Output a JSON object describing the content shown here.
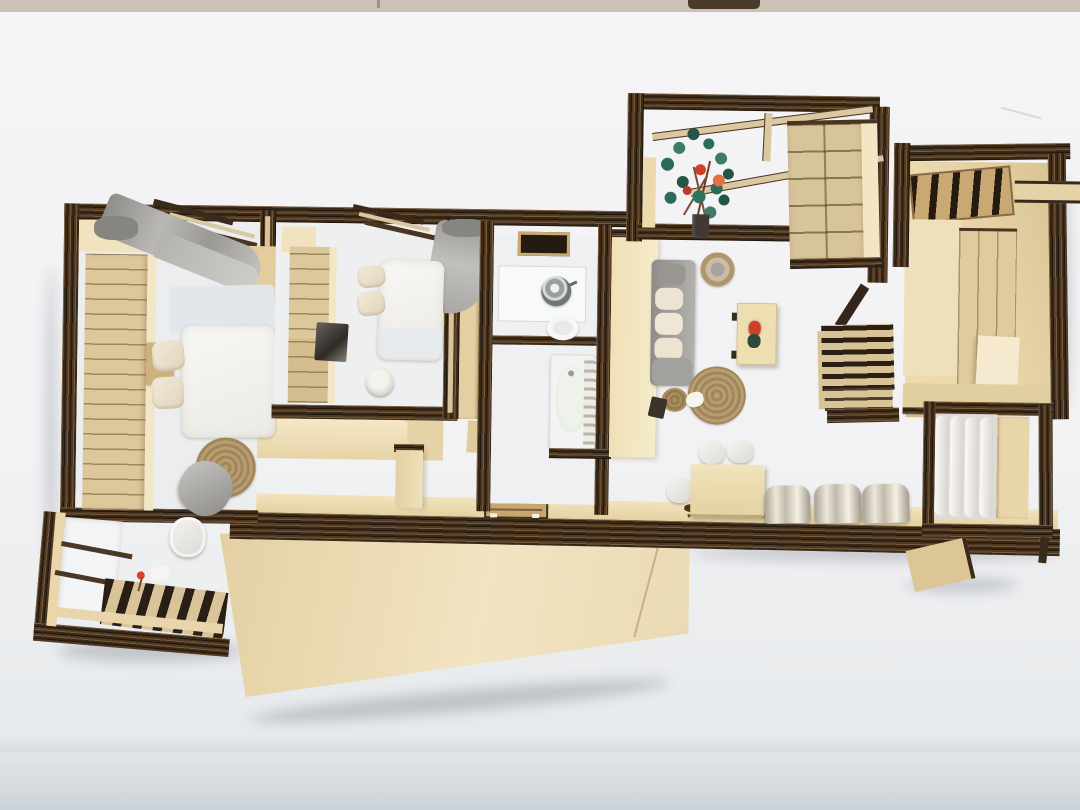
{
  "scene": {
    "type": "photograph",
    "subject": "Top-down photo of a laser-cut plywood architectural scale model of an apartment interior, standing on a white paper backdrop",
    "backdrop": "white seamless sweep over a table edge",
    "palette": {
      "backdrop": "#f3f4f6",
      "table_strip": "#cac3b5",
      "floor_shadow": "#d2d8dc",
      "plywood_face": "#e8d5ab",
      "plywood_light": "#f2e6c6",
      "plywood_mid": "#d8c294",
      "burnt_edge": "#382818",
      "edge_stripe": "#7d5430",
      "fabric_white": "#f4f3ef",
      "fabric_gray": "#a5a3a0",
      "jute": "#b1976b",
      "brushed_metal": "#cfc9bb",
      "plant_green": "#2e6a59",
      "flower_red": "#cf3f2c",
      "flower_orange": "#e2713f"
    },
    "rooms": [
      {
        "name": "master-bedroom",
        "contents": [
          "slatted-wardrobe",
          "double-bed",
          "two-pillows",
          "gray-curtain",
          "round-jute-rug",
          "gray-pouf",
          "white-stool",
          "side-cabinet",
          "desk"
        ]
      },
      {
        "name": "master-balcony",
        "contents": [
          "window-wall",
          "slatted-deck",
          "red-flower",
          "white-paper"
        ]
      },
      {
        "name": "second-bedroom",
        "contents": [
          "slatted-wardrobe",
          "vanity-mirror",
          "double-bed",
          "two-pillows",
          "gray-curtain",
          "round-stool"
        ]
      },
      {
        "name": "bathroom",
        "contents": [
          "washing-machine",
          "toilet",
          "bathtub",
          "towel-ladder",
          "transom-window"
        ]
      },
      {
        "name": "living-room",
        "contents": [
          "gray-sofa",
          "cream-cushions",
          "hanging-basket",
          "coffee-table",
          "red-flower-decor",
          "round-jute-rug",
          "rope-coil",
          "ceramic-cat",
          "white-poufs",
          "dining-table",
          "three-metal-chairs",
          "palm-frond"
        ]
      },
      {
        "name": "north-balcony",
        "contents": [
          "flowering-plant",
          "dark-planter",
          "glass-roof-beams",
          "chest-of-drawers"
        ]
      },
      {
        "name": "kitchen",
        "contents": [
          "louvered-window",
          "tall-cabinets",
          "lower-cabinets",
          "wall-shelf"
        ]
      },
      {
        "name": "louvered-screen-partition",
        "contents": []
      },
      {
        "name": "utility-balcony",
        "contents": [
          "pleated-white-curtains",
          "side-panel",
          "support-wedge"
        ]
      },
      {
        "name": "entry-corridor",
        "contents": [
          "long-floor-slab",
          "floor-hatch"
        ]
      }
    ],
    "counts": {
      "bedrooms": 2,
      "bathrooms": 1,
      "balconies": 3,
      "metal_chairs": 3,
      "round_rugs": 2
    }
  }
}
